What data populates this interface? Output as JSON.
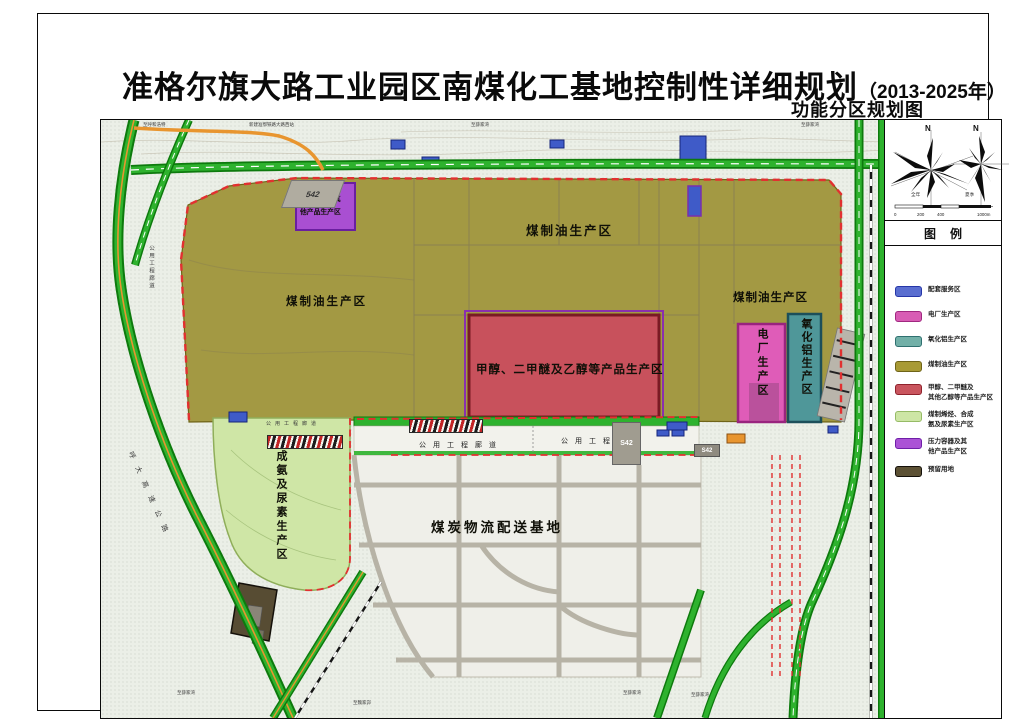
{
  "title": {
    "main": "准格尔旗大路工业园区南煤化工基地控制性详细规划",
    "year_suffix": "（2013-2025年）",
    "subtitle": "功能分区规划图"
  },
  "map": {
    "zones": {
      "coal_oil_top": "煤制油生产区",
      "coal_oil_left": "煤制油生产区",
      "coal_oil_right": "煤制油生产区",
      "methanol": "甲醇、二甲醚及乙醇等产品生产区",
      "power_plant": "电厂生产区",
      "alumina": "氧化铝生产区",
      "ammonia_urea": "合成氨及尿素生产区",
      "coal_logistics": "煤炭物流配送基地",
      "pressure_vessel_line1": "压力容器及其",
      "pressure_vessel_line2": "他产品生产区"
    },
    "corridor_label": "公用工程廊道",
    "road_signs": {
      "top_left": "542",
      "corridor": "S42",
      "lower": "S42"
    },
    "small_labels": {
      "top_far_left": "至呼和浩特",
      "top_station": "新建准鄂铁路大路西站",
      "top_mid": "至薛家湾",
      "top_right": "至薛家湾",
      "bottom_left_1": "至薛家湾",
      "bottom_left_2": "至魏家峁",
      "bottom_right_1": "至薛家湾",
      "bottom_right_2": "至薛家湾",
      "expressway": "呼大高速公路"
    }
  },
  "panel": {
    "legend_header": "图例",
    "compass": {
      "north": "N",
      "caption_left": "全年",
      "caption_right": "夏季",
      "scale_labels": [
        "0",
        "200",
        "400",
        "1000m"
      ]
    },
    "legend_items": [
      {
        "label1": "配套服务区",
        "label2": "",
        "color": "#5a6ed0",
        "border": "#2636a8"
      },
      {
        "label1": "电厂生产区",
        "label2": "",
        "color": "#d85cb4",
        "border": "#a02880"
      },
      {
        "label1": "氧化铝生产区",
        "label2": "",
        "color": "#72b0a8",
        "border": "#2f7070"
      },
      {
        "label1": "煤制油生产区",
        "label2": "",
        "color": "#a89a35",
        "border": "#6f6418"
      },
      {
        "label1": "甲醇、二甲醚及",
        "label2": "其他乙醇等产品生产区",
        "color": "#c9555e",
        "border": "#8f222c"
      },
      {
        "label1": "煤制烯烃、合成",
        "label2": "氨及尿素生产区",
        "color": "#cde6a5",
        "border": "#96bb66"
      },
      {
        "label1": "压力容器及其",
        "label2": "他产品生产区",
        "color": "#ab52d6",
        "border": "#6f1fa8"
      },
      {
        "label1": "预留用地",
        "label2": "",
        "color": "#5c5134",
        "border": "#14100a"
      }
    ]
  },
  "colors": {
    "coal_oil": "#a39943",
    "methanol_zone": "#c8515c",
    "power_zone": "#df5cb8",
    "power_zone_dark": "#b44f96",
    "alumina_zone": "#4f9799",
    "ammonia_zone": "#cfe6a6",
    "pressure_zone": "#a94fd2",
    "reserved_zone": "#574c33",
    "service_blue": "#3f5bc8",
    "road_green": "#2eb22e",
    "road_green_dark": "#0d7a0d",
    "road_orange": "#e8952f",
    "boundary_red": "#e23030"
  }
}
